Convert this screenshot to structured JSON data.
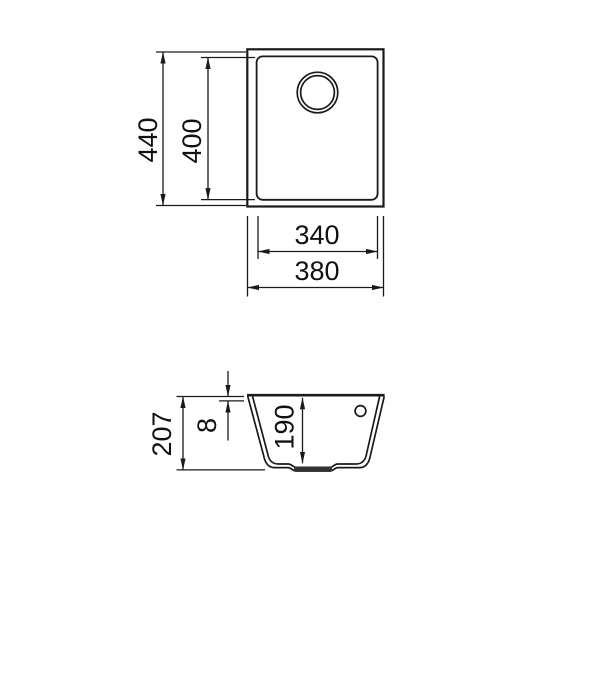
{
  "drawing": {
    "background_color": "#ffffff",
    "line_color": "#1a1a1a",
    "top_view": {
      "dims": {
        "overall_height": "440",
        "inner_height": "400",
        "inner_width": "340",
        "overall_width": "380"
      }
    },
    "side_view": {
      "dims": {
        "overall_depth": "207",
        "rim_thickness": "8",
        "bowl_depth": "190"
      }
    }
  }
}
